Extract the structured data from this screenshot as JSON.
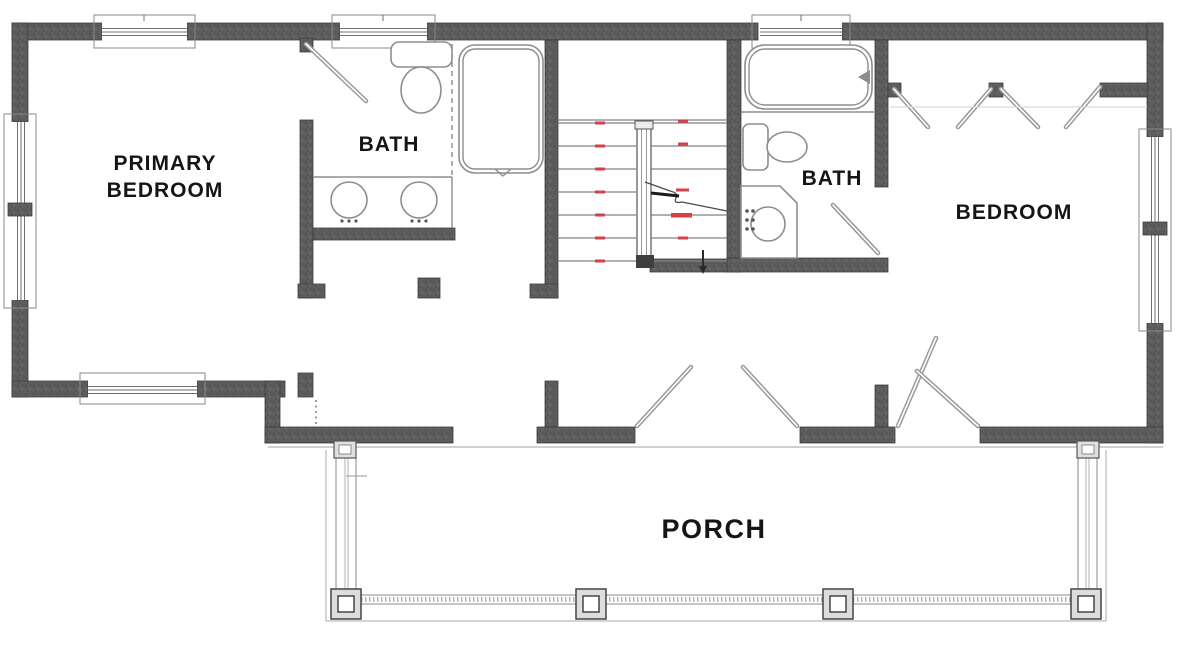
{
  "labels": {
    "primary_bedroom_line1": "PRIMARY",
    "primary_bedroom_line2": "BEDROOM",
    "primary_bath": "BATH",
    "hall_bath": "BATH",
    "bedroom": "BEDROOM",
    "porch": "PORCH"
  },
  "colors": {
    "wall": "#5a5a5a",
    "wall_outline": "#3d3d3d",
    "thin_line": "#7a7a7a",
    "door_leaf": "#9a9a9a",
    "stair_marker_red": "#d4414b",
    "text": "#151515",
    "background": "#ffffff"
  }
}
